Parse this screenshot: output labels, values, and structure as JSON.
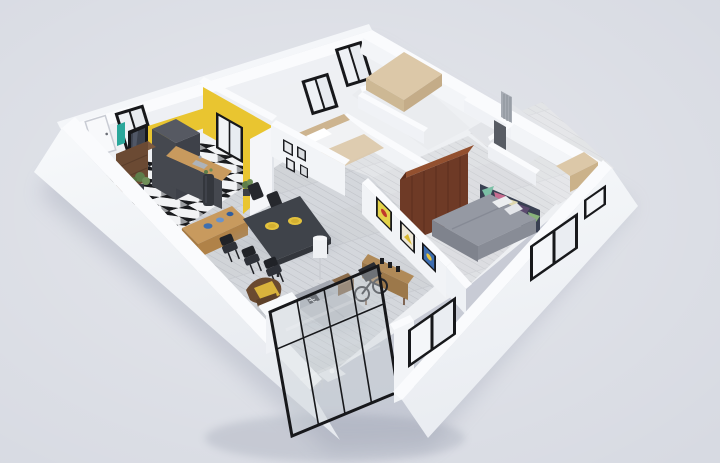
{
  "scene": {
    "description": "3D isometric cutaway floor plan render of an apartment, viewed from above at an angle on a plain light grey background",
    "style": "photoreal architectural dollhouse render, no visible text",
    "palette": {
      "background": "#d7dae2",
      "wall_top": "#fafbfd",
      "wall_face_light": "#f1f3f6",
      "wall_face_shade": "#e8ebf0",
      "wall_exterior": "#f4f6f9",
      "accent_yellow": "#e9c530",
      "cabinet_charcoal": "#45484f",
      "cabinet_dark": "#3e4149",
      "counter_wood": "#c89a5e",
      "bar_wood_face": "#b08248",
      "wardrobe_wood": "#6e3a26",
      "wardrobe_wood_dark": "#5a2d1c",
      "table_wood_dark": "#3f434a",
      "chair_black": "#26282d",
      "sofa_gray": "#b7bbc2",
      "sofa_gray_dark": "#a3a7b0",
      "bed_gray": "#9599a3",
      "armchair_yellow": "#d9b33c",
      "armchair_frame": "#6a4a30",
      "sideboard_wood": "#b08a58",
      "dresser_wood": "#6b4a33",
      "tan_furniture": "#dcc8a8",
      "floor_plank": "#d6d8dc",
      "tile_black": "#1a1b1e",
      "tile_white": "#f2f3f5",
      "window_frame": "#17181b",
      "window_glass": "#f2f4f7",
      "glass_tint": "#cdd3da",
      "plant_green": "#5e7d4a",
      "teal_accent": "#2aa79b",
      "plate_yellow": "#e3c23e",
      "bowl_blue": "#3f6fae"
    },
    "rooms": [
      {
        "id": "entrance-hall",
        "label": "entrance hall"
      },
      {
        "id": "kitchen",
        "label": "kitchen with yellow accent wall"
      },
      {
        "id": "dining-area",
        "label": "dining area"
      },
      {
        "id": "living-room",
        "label": "living room with glass partition"
      },
      {
        "id": "hallway",
        "label": "central hallway"
      },
      {
        "id": "master-bedroom",
        "label": "master bedroom"
      },
      {
        "id": "back-bedroom",
        "label": "back bedroom"
      },
      {
        "id": "bathroom",
        "label": "bathroom"
      },
      {
        "id": "walk-in-closet",
        "label": "side room / closet"
      }
    ],
    "furniture": [
      "charcoal kitchen cabinets with wood counter",
      "wood breakfast bar with blue bowls",
      "black and white mosaic tile kitchen floor",
      "dark wood dining table with six black chairs and two yellow plates",
      "grey fabric sofa with patterned cushion",
      "yellow armchair with dark wood frame",
      "white floor lamp",
      "coffee table behind glass wall",
      "light wood sideboard with black decor objects",
      "three framed colourful posters on living room wall",
      "four small black picture frames on dining wall",
      "large dark wood wardrobe",
      "double bed with grey bedding and multicolour geometric headboard art",
      "entry dresser with black framed mirror, teal towel and potted plant",
      "tan desk and bed in back rooms",
      "leaning bicycle and wooden crate",
      "black steel framed glass partition",
      "black framed windows on all exterior walls"
    ]
  }
}
